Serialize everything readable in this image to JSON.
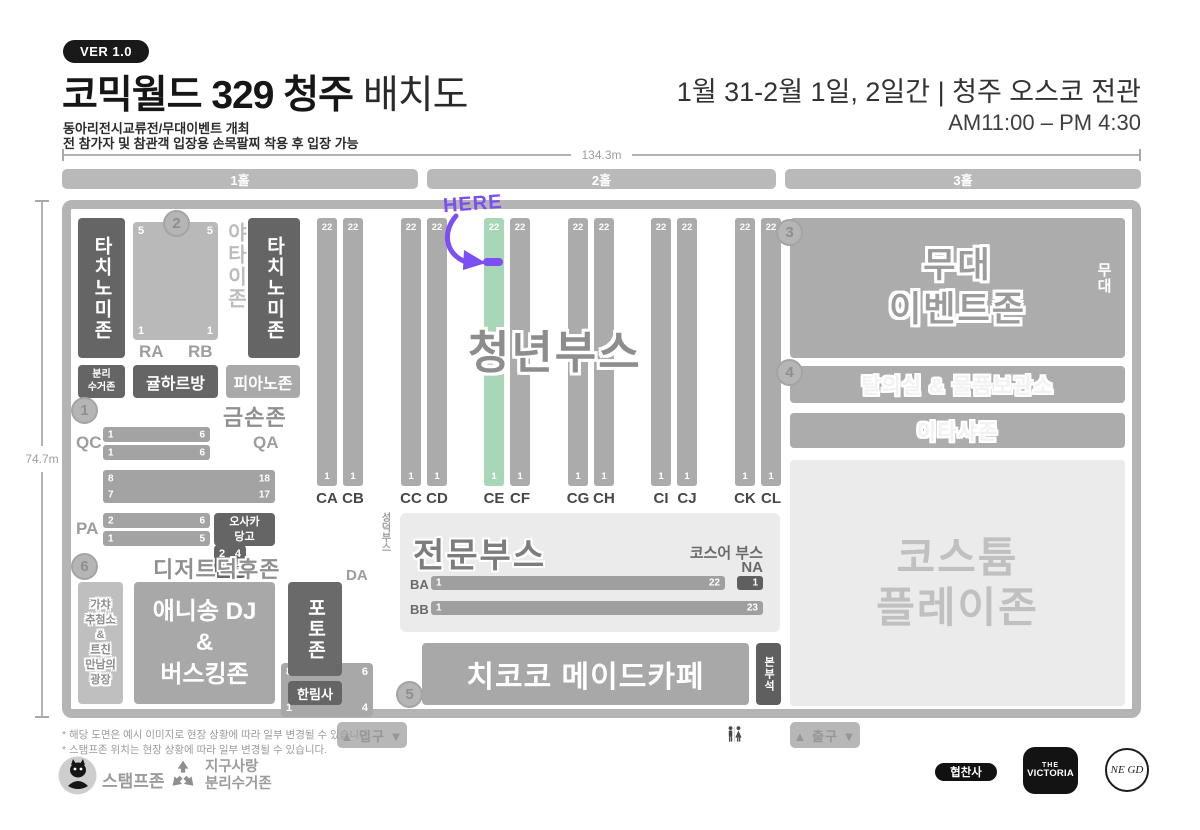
{
  "header": {
    "version_badge": "VER 1.0",
    "title_main": "코믹월드 329 청주 ",
    "title_suffix": "배치도",
    "subtitle_line1": "동아리전시교류전/무대이벤트 개최",
    "subtitle_line2": "전 참가자 및 참관객 입장용 손목팔찌 착용 후 입장 가능",
    "date_venue": "1월 31-2월 1일, 2일간 | 청주 오스코 전관",
    "time": "AM11:00 – PM 4:30"
  },
  "measure": {
    "width_label": "134.3m",
    "height_label": "74.7m"
  },
  "halls": [
    "1홀",
    "2홀",
    "3홀"
  ],
  "markers": {
    "m1": "1",
    "m2": "2",
    "m3": "3",
    "m4": "4",
    "m5": "5",
    "m6": "6"
  },
  "hall1": {
    "tachinomi_left": "타치노미존",
    "yatai": "야타이존",
    "tachinomi_right": "타치노미존",
    "rarb": {
      "tl": "5",
      "tr": "5",
      "bl": "1",
      "br": "1",
      "label_left": "RA",
      "label_right": "RB"
    },
    "bunri": "분리\n수거존",
    "gyulharbang": "귤하르방",
    "piano": "피아노존",
    "geumson_title": "금손존",
    "qc": {
      "label": "QC",
      "row1_left": "1",
      "row1_right": "6",
      "row2_left": "1",
      "row2_right": "6"
    },
    "qa": {
      "label": "QA",
      "tl": "2",
      "tr": "4",
      "bl": "1",
      "br": "3"
    },
    "double_bar": {
      "row1_left": "8",
      "row1_right": "18",
      "row2_left": "7",
      "row2_right": "17"
    },
    "pa": {
      "label": "PA",
      "row1_left": "2",
      "row1_right": "6",
      "row2_left": "1",
      "row2_right": "5"
    },
    "osaka": "오사카\n당고",
    "da": {
      "label": "DA",
      "tl": "8",
      "tr": "6",
      "bl": "1",
      "br": "4",
      "side": "성덕부스"
    },
    "dessert_title": "디저트덕후존",
    "gacha": "가챠\n추첨소\n&\n트친\n만남의\n광장",
    "anisong": "애니송 DJ\n&\n버스킹존",
    "photo": "포토존",
    "hanrim": "한림사"
  },
  "youth_booths": {
    "title": "청년부스",
    "here_label": "HERE",
    "columns": [
      {
        "label": "CA",
        "top": "22",
        "bottom": "1",
        "highlight": false
      },
      {
        "label": "CB",
        "top": "22",
        "bottom": "1",
        "highlight": false
      },
      {
        "label": "CC",
        "top": "22",
        "bottom": "1",
        "highlight": false
      },
      {
        "label": "CD",
        "top": "22",
        "bottom": "1",
        "highlight": false
      },
      {
        "label": "CE",
        "top": "22",
        "bottom": "1",
        "highlight": true
      },
      {
        "label": "CF",
        "top": "22",
        "bottom": "1",
        "highlight": false
      },
      {
        "label": "CG",
        "top": "22",
        "bottom": "1",
        "highlight": false
      },
      {
        "label": "CH",
        "top": "22",
        "bottom": "1",
        "highlight": false
      },
      {
        "label": "CI",
        "top": "22",
        "bottom": "1",
        "highlight": false
      },
      {
        "label": "CJ",
        "top": "22",
        "bottom": "1",
        "highlight": false
      },
      {
        "label": "CK",
        "top": "22",
        "bottom": "1",
        "highlight": false
      },
      {
        "label": "CL",
        "top": "22",
        "bottom": "1",
        "highlight": false
      }
    ]
  },
  "hall2": {
    "pro_booth": {
      "title": "전문부스",
      "cos_label": "코스어 부스",
      "na_label": "NA",
      "ba_label": "BA",
      "ba_left": "1",
      "ba_right": "22",
      "ba_na": "1",
      "bb_label": "BB",
      "bb_left": "1",
      "bb_right": "23"
    },
    "maid_cafe": "치코코 메이드카페",
    "bonbu": "본부석"
  },
  "hall3": {
    "stage_zone": "무대\n이벤트존",
    "stage_side": "무대",
    "changing": "탈의실 & 물품보관소",
    "itasha": "이타샤존",
    "costume": "코스튬\n플레이존"
  },
  "gates": {
    "entrance": "▲ 입구 ▼",
    "exit": "▲ 출구 ▼"
  },
  "footer": {
    "note1": "* 해당 도면은 예시 이미지로 현장 상황에 따라 일부 변경될 수 있습니다.",
    "note2": "* 스탬프존 위치는 현장 상황에 따라 일부 변경될 수 있습니다.",
    "stamp_zone": "스탬프존",
    "recycle_zone": "지구사랑\n분리수거존",
    "sponsor_badge": "협찬사",
    "victoria_top": "THE",
    "victoria_main": "VICTORIA",
    "negd": "NE GD"
  },
  "colors": {
    "accent_purple": "#7b4ff2",
    "highlight_green": "#a7d7b7"
  }
}
